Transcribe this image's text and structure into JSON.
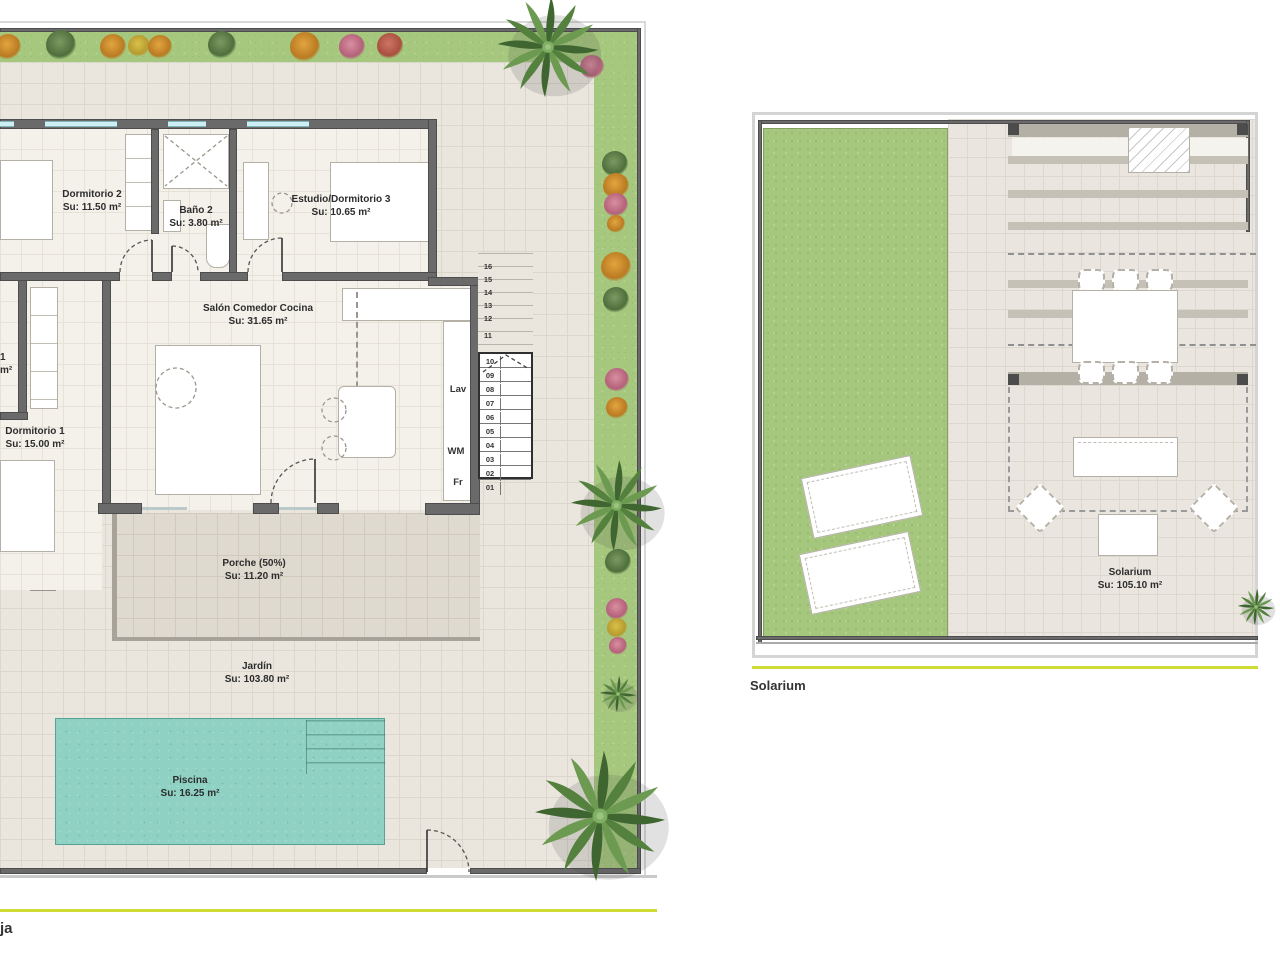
{
  "ground_floor": {
    "caption": "ja",
    "rooms": [
      {
        "name": "Dormitorio 2",
        "area": "Su: 11.50 m²"
      },
      {
        "name": "Baño 2",
        "area": "Su: 3.80 m²"
      },
      {
        "name": "Estudio/Dormitorio 3",
        "area": "Su: 10.65 m²"
      },
      {
        "name": "Salón Comedor Cocina",
        "area": "Su: 31.65 m²"
      },
      {
        "name": "Dormitorio 1",
        "area": "Su: 15.00 m²"
      },
      {
        "name": "Porche (50%)",
        "area": "Su: 11.20 m²"
      },
      {
        "name": "Jardín",
        "area": "Su: 103.80 m²"
      },
      {
        "name": "Piscina",
        "area": "Su: 16.25 m²"
      }
    ],
    "clipped_label": {
      "line1": "1",
      "line2": "m²"
    },
    "appliances": {
      "lav": "Lav",
      "wm": "WM",
      "fr": "Fr"
    },
    "stairs": {
      "upper": [
        "16",
        "15",
        "14",
        "13",
        "12",
        "11"
      ],
      "lower": [
        "10",
        "09",
        "08",
        "07",
        "06",
        "05",
        "04",
        "03",
        "02",
        "01"
      ]
    }
  },
  "solarium": {
    "caption": "Solarium",
    "room": {
      "name": "Solarium",
      "area": "Su: 105.10 m²"
    }
  },
  "colors": {
    "accent_line": "#cedd33",
    "pool": "#8fd2c4",
    "lawn": "#a5c77d",
    "tile": "#eae6de",
    "wall": "#6a6a6a"
  }
}
